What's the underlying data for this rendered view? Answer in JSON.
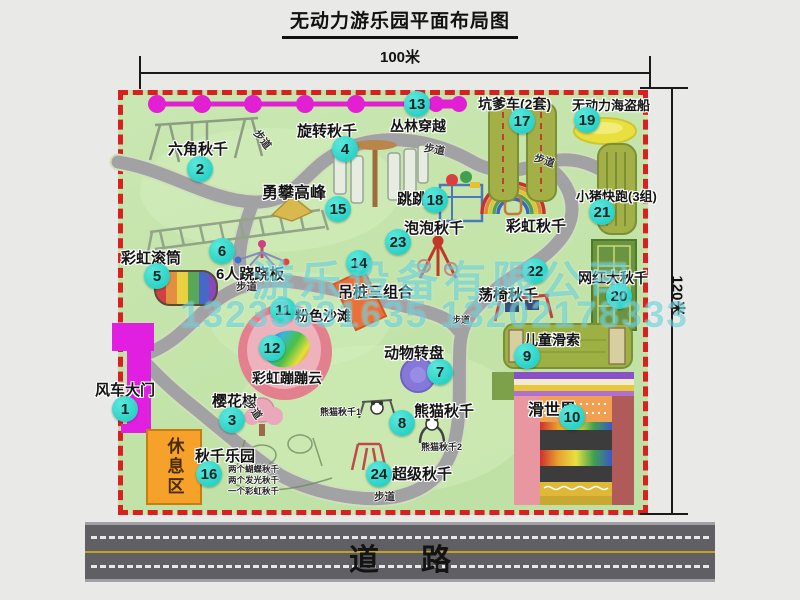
{
  "title": "无动力游乐园平面布局图",
  "dimensions": {
    "width_label": "100米",
    "height_label": "120米"
  },
  "road": {
    "label": "道路"
  },
  "rest_area": {
    "label": "休息区"
  },
  "trail_label": "步道",
  "rainbow_swing_label": "彩虹秋千",
  "watermark": {
    "company": "游乐设备有限公司",
    "phone": "13233831635 13202178333"
  },
  "map_colors": {
    "ground": "#c2e3a8",
    "border_dash": "#d92020",
    "path": "#a2a2a4",
    "badge": "#2bd2c6",
    "zipline": "#e31fd3",
    "gate": "#e11fe1",
    "rest_area": "#f6a22a",
    "mat_olive": "#a3b048",
    "road": "#5f5f64"
  },
  "attractions": [
    {
      "num": "1",
      "name": "风车大门"
    },
    {
      "num": "2",
      "name": "六角秋千"
    },
    {
      "num": "3",
      "name": "樱花树"
    },
    {
      "num": "4",
      "name": "旋转秋千"
    },
    {
      "num": "5",
      "name": "彩虹滚筒"
    },
    {
      "num": "6",
      "name": "6人跷跷板"
    },
    {
      "num": "7",
      "name": "动物转盘"
    },
    {
      "num": "8",
      "name": "熊猫秋千",
      "sub1": "熊猫秋千1",
      "sub2": "熊猫秋千2"
    },
    {
      "num": "9",
      "name": "儿童滑索"
    },
    {
      "num": "10",
      "name": "滑世界"
    },
    {
      "num": "11",
      "name": "粉色沙滩"
    },
    {
      "num": "12",
      "name": "彩虹蹦蹦云"
    },
    {
      "num": "13",
      "name": "丛林穿越"
    },
    {
      "num": "14",
      "name": "吊桩三组合"
    },
    {
      "num": "15",
      "name": "勇攀高峰"
    },
    {
      "num": "16",
      "name": "秋千乐园",
      "notes": [
        "两个蝴蝶秋千",
        "两个发光秋千",
        "一个彩虹秋千"
      ]
    },
    {
      "num": "17",
      "name": "坑爹车(2套)"
    },
    {
      "num": "18",
      "name": "跳跳马"
    },
    {
      "num": "19",
      "name": "无动力海盗船"
    },
    {
      "num": "20",
      "name": "网红大秋千"
    },
    {
      "num": "21",
      "name": "小猪快跑(3组)"
    },
    {
      "num": "22",
      "name": "荡椅秋千"
    },
    {
      "num": "23",
      "name": "泡泡秋千"
    },
    {
      "num": "24",
      "name": "超级秋千"
    }
  ]
}
